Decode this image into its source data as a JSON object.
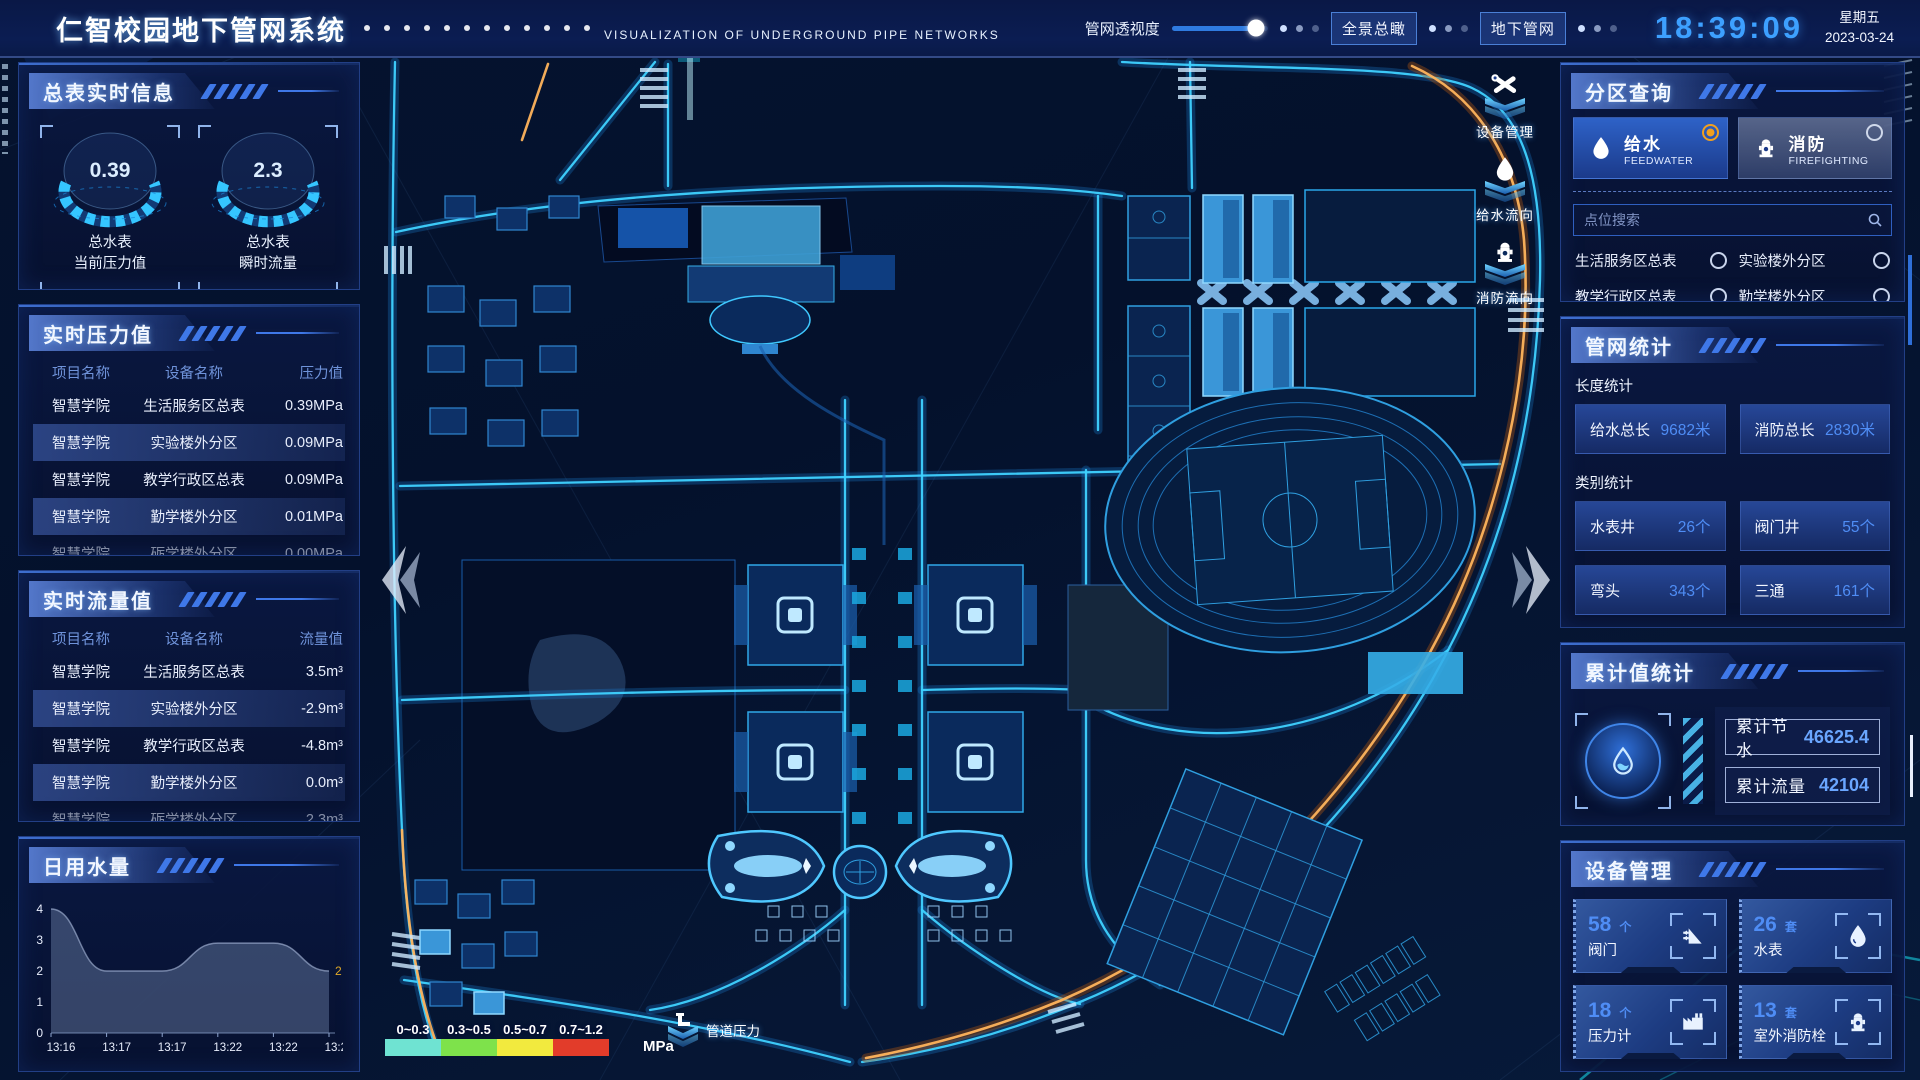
{
  "colors": {
    "accent": "#3fd2ff",
    "value_blue": "#4f8df5",
    "warn_orange": "#f0a020",
    "time_blue": "#3da0ff"
  },
  "header": {
    "title": "仁智校园地下管网系统",
    "subtitle": "VISUALIZATION OF UNDERGROUND PIPE NETWORKS",
    "opacity_label": "管网透视度",
    "btn_overview": "全景总瞰",
    "btn_underground": "地下管网",
    "time": "18:39:09",
    "weekday": "星期五",
    "date": "2023-03-24"
  },
  "left": {
    "meter_panel": {
      "title": "总表实时信息",
      "gauges": [
        {
          "value": "0.39",
          "label1": "总水表",
          "label2": "当前压力值"
        },
        {
          "value": "2.3",
          "label1": "总水表",
          "label2": "瞬时流量"
        }
      ]
    },
    "pressure": {
      "title": "实时压力值",
      "headers": [
        "项目名称",
        "设备名称",
        "压力值"
      ],
      "rows": [
        [
          "智慧学院",
          "生活服务区总表",
          "0.39MPa"
        ],
        [
          "智慧学院",
          "实验楼外分区",
          "0.09MPa"
        ],
        [
          "智慧学院",
          "教学行政区总表",
          "0.09MPa"
        ],
        [
          "智慧学院",
          "勤学楼外分区",
          "0.01MPa"
        ],
        [
          "智慧学院",
          "砺学楼外分区",
          "0.00MPa"
        ]
      ]
    },
    "flow": {
      "title": "实时流量值",
      "headers": [
        "项目名称",
        "设备名称",
        "流量值"
      ],
      "rows": [
        [
          "智慧学院",
          "生活服务区总表",
          "3.5m³"
        ],
        [
          "智慧学院",
          "实验楼外分区",
          "-2.9m³"
        ],
        [
          "智慧学院",
          "教学行政区总表",
          "-4.8m³"
        ],
        [
          "智慧学院",
          "勤学楼外分区",
          "0.0m³"
        ],
        [
          "智慧学院",
          "砺学楼外分区",
          "2.3m³"
        ]
      ]
    },
    "daily": {
      "title": "日用水量"
    }
  },
  "chart_data": {
    "type": "area",
    "title": "日用水量",
    "x": [
      "13:16",
      "13:17",
      "13:17",
      "13:22",
      "13:22",
      "13:23"
    ],
    "values": [
      4,
      2,
      2,
      2.9,
      2.9,
      2
    ],
    "yticks": [
      0,
      1,
      2,
      3,
      4
    ],
    "ylim": [
      0,
      4
    ],
    "end_label": "2",
    "end_label_color": "#e0a928",
    "area_color": "rgba(130,150,190,0.38)",
    "grid": false,
    "legend_position": "none"
  },
  "map": {
    "toolbar": [
      {
        "label": "设备管理",
        "icon": "wrench-icon"
      },
      {
        "label": "给水流向",
        "icon": "water-drop-icon"
      },
      {
        "label": "消防流向",
        "icon": "hydrant-icon"
      }
    ],
    "legend": {
      "ranges": [
        {
          "label": "0~0.3",
          "color": "#6fe3d2"
        },
        {
          "label": "0.3~0.5",
          "color": "#7ee24b"
        },
        {
          "label": "0.5~0.7",
          "color": "#f2ea3e"
        },
        {
          "label": "0.7~1.2",
          "color": "#e23c2a"
        }
      ],
      "unit": "MPa",
      "pipe_pressure_label": "管道压力"
    }
  },
  "right": {
    "zone": {
      "title": "分区查询",
      "tabs": [
        {
          "label": "给水",
          "sub": "FEEDWATER",
          "selected": true
        },
        {
          "label": "消防",
          "sub": "FIREFIGHTING",
          "selected": false
        }
      ],
      "search_placeholder": "点位搜索",
      "items": [
        "生活服务区总表",
        "实验楼外分区",
        "教学行政区总表",
        "勤学楼外分区",
        "砺学楼外分区",
        "宿舍区泵房"
      ]
    },
    "stats": {
      "title": "管网统计",
      "length_title": "长度统计",
      "length_items": [
        {
          "label": "给水总长",
          "value": "9682米"
        },
        {
          "label": "消防总长",
          "value": "2830米"
        }
      ],
      "category_title": "类别统计",
      "category_items": [
        {
          "label": "水表井",
          "value": "26个"
        },
        {
          "label": "阀门井",
          "value": "55个"
        },
        {
          "label": "弯头",
          "value": "343个"
        },
        {
          "label": "三通",
          "value": "161个"
        }
      ]
    },
    "accum": {
      "title": "累计值统计",
      "items": [
        {
          "label": "累计节水",
          "value": "46625.4"
        },
        {
          "label": "累计流量",
          "value": "42104"
        }
      ]
    },
    "devices": {
      "title": "设备管理",
      "items": [
        {
          "count": "58",
          "unit": "个",
          "label": "阀门",
          "icon": "valve-icon"
        },
        {
          "count": "26",
          "unit": "套",
          "label": "水表",
          "icon": "water-meter-icon"
        },
        {
          "count": "18",
          "unit": "个",
          "label": "压力计",
          "icon": "pressure-gauge-icon"
        },
        {
          "count": "13",
          "unit": "套",
          "label": "室外消防栓",
          "icon": "hydrant-icon"
        }
      ]
    }
  }
}
